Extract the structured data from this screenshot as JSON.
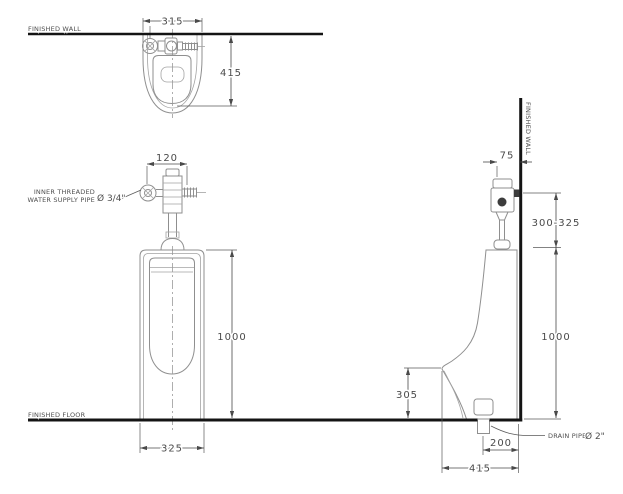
{
  "drawing": {
    "type": "technical-installation-diagram",
    "subject": "wall-hung urinal with flush valve, three orthographic views",
    "labels": {
      "wall_top": "FINISHED WALL",
      "wall_side": "FINISHED WALL",
      "floor": "FINISHED FLOOR",
      "supply_line1": "INNER THREADED",
      "supply_line2": "WATER SUPPLY PIPE",
      "supply_size": "Ø 3/4\"",
      "drain": "DRAIN PIPE",
      "drain_size": "Ø 2\""
    },
    "dimensions": {
      "top_view": {
        "width": "315",
        "depth": "415"
      },
      "front_view": {
        "valve_offset": "120",
        "height": "1000",
        "width": "325"
      },
      "side_view": {
        "valve_to_wall": "75",
        "supply_height_range": "300-325",
        "height": "1000",
        "lip_height": "305",
        "drain_offset": "200",
        "depth": "415"
      }
    },
    "colors": {
      "background": "#ffffff",
      "structure_line": "#141414",
      "fixture_line": "#8f8f8f",
      "dimension_line": "#4a4a4a",
      "dimension_text": "#4a4a4a"
    }
  }
}
